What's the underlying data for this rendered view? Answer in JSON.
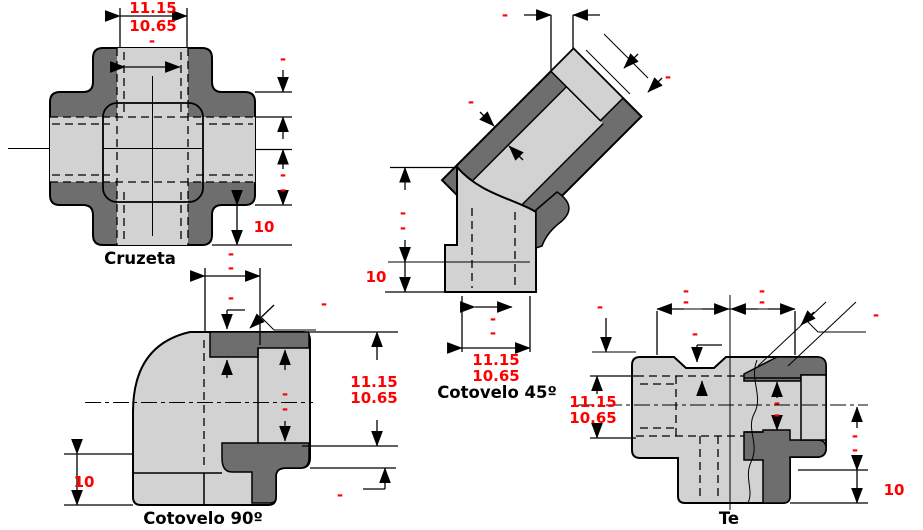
{
  "colors": {
    "body_light": "#d2d2d2",
    "body_dark": "#6e6e6e",
    "dim_red": "#ff0000",
    "line": "#000000",
    "background": "#ffffff"
  },
  "cruzeta": {
    "title": "Cruzeta",
    "d_max": "11.15",
    "d_min": "10.65",
    "d_nom": "-",
    "d_rt": "-",
    "d_ra": "-",
    "d_rb": "-",
    "d_ten": "10"
  },
  "cotovelo90": {
    "title": "Cotovelo 90º",
    "d_ta": "-",
    "d_tb": "-",
    "d_tc": "-",
    "d_leader": "-",
    "d_ba": "-",
    "d_bb": "-",
    "d_max": "11.15",
    "d_min": "10.65",
    "d_low": "-",
    "d_ten": "10"
  },
  "cotovelo45": {
    "title": "Cotovelo 45º",
    "d_gap": "-",
    "d_wall": "-",
    "d_end": "-",
    "d_la": "-",
    "d_lb": "-",
    "d_ten": "10",
    "d_ba": "-",
    "d_bb": "-",
    "d_max": "11.15",
    "d_min": "10.65"
  },
  "te": {
    "title": "Te",
    "d_tl": "-",
    "d_r1l": "-",
    "d_r1r": "-",
    "d_r2l": "-",
    "d_r2r": "-",
    "d_mid": "-",
    "d_leader": "-",
    "d_max": "11.15",
    "d_min": "10.65",
    "d_bl": "-",
    "d_bra": "-",
    "d_brb": "-",
    "d_ra": "-",
    "d_rb": "-",
    "d_ten": "10"
  }
}
